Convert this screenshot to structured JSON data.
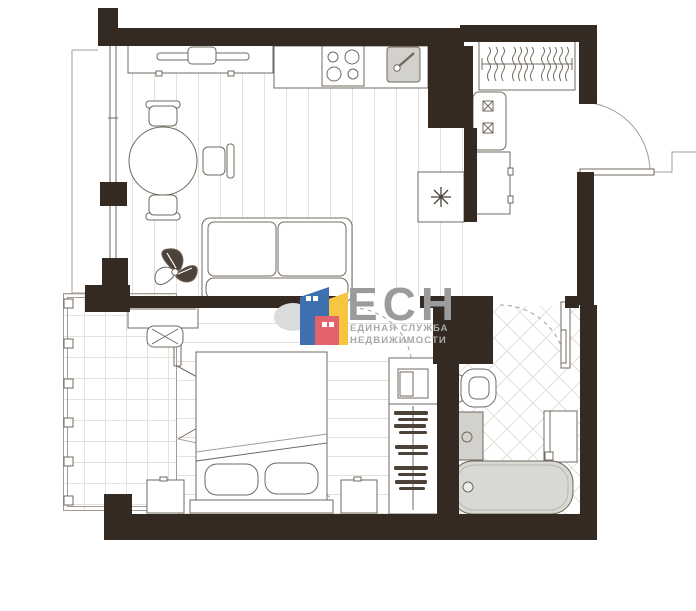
{
  "watermark": {
    "brand": "ЕСН",
    "tagline_line1": "ЕДИНАЯ СЛУЖБА",
    "tagline_line2": "НЕДВИЖИМОСТИ"
  },
  "colors": {
    "wall": "#352a21",
    "outline": "#70685f",
    "outline_light": "#a49c93",
    "floor_line": "#e5e0d9",
    "fill_gray": "#d2d1cc",
    "tub_fill": "#d9d9d4",
    "clothes": "#4c4238",
    "logo_gray": "#9b9b9b",
    "logo_gray_light": "#a8a8a8",
    "logo_blue": "#3e6fae",
    "logo_yellow": "#f6c640",
    "logo_red": "#e2636b",
    "logo_cloud": "#dcdcdc",
    "background": "#ffffff"
  },
  "plan": {
    "type": "apartment-floor-plan",
    "rooms": [
      {
        "name": "kitchen-living-room",
        "furniture": [
          "tv-console",
          "tv",
          "dining-table",
          "dining-chairs",
          "sofa",
          "plant",
          "kitchen-counter",
          "stove",
          "kitchen-sink",
          "refrigerator"
        ]
      },
      {
        "name": "hallway",
        "furniture": [
          "wardrobe-with-hangers",
          "shoe-cabinet",
          "hall-cabinet",
          "entry-door"
        ]
      },
      {
        "name": "bedroom",
        "furniture": [
          "double-bed",
          "pillows",
          "nightstand-left",
          "nightstand-right",
          "dressing-table",
          "stool",
          "wardrobe-column",
          "balcony-folding-door"
        ]
      },
      {
        "name": "bathroom",
        "furniture": [
          "toilet",
          "sink-vanity",
          "bath-cabinet",
          "towel-rail",
          "bathtub",
          "bathroom-door"
        ]
      },
      {
        "name": "balcony",
        "furniture": [
          "railing-posts"
        ]
      }
    ]
  }
}
